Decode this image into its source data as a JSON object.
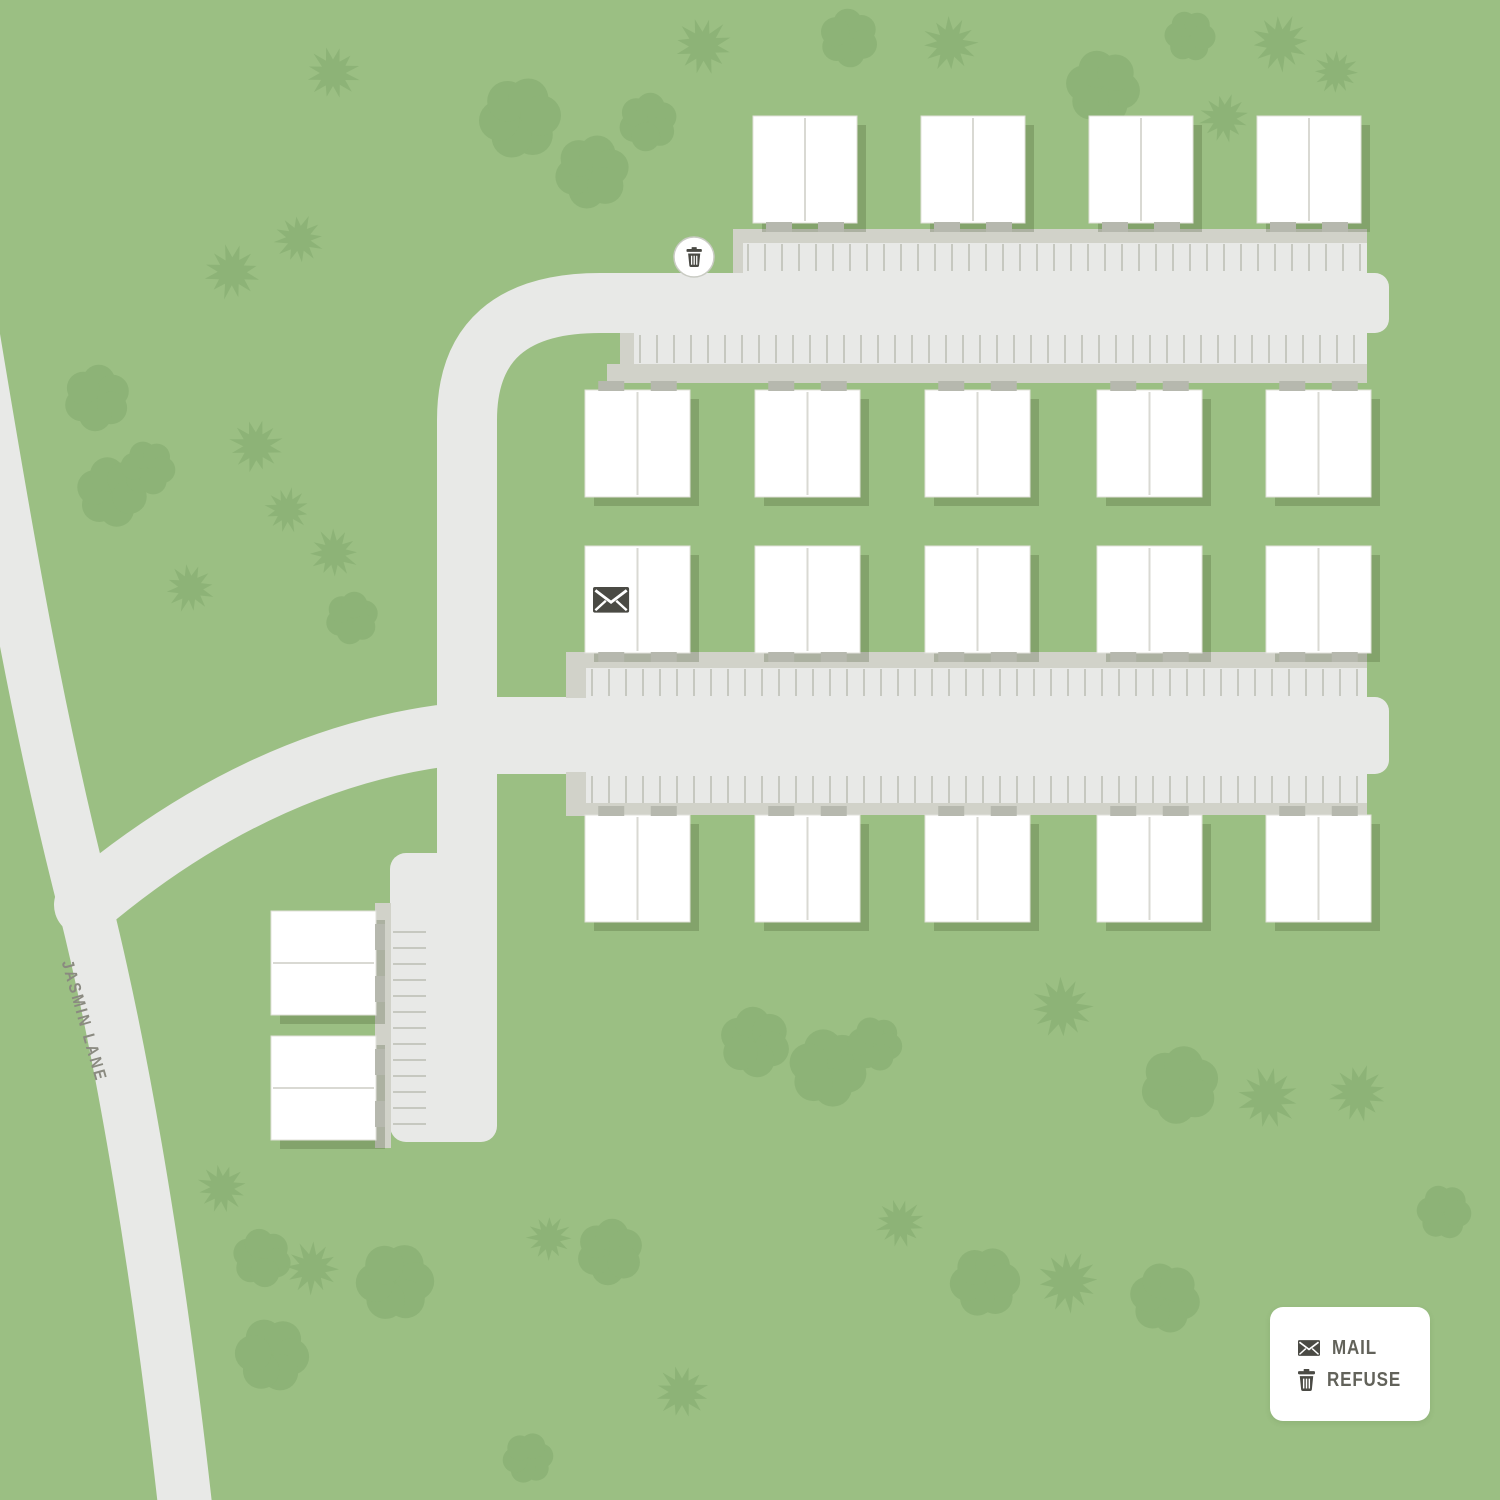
{
  "title": "Jasmin Lane community site map",
  "street": {
    "label": "JASMIN LANE"
  },
  "legend": {
    "items": [
      {
        "icon": "mail-icon",
        "label": "MAIL"
      },
      {
        "icon": "refuse-icon",
        "label": "REFUSE"
      }
    ]
  },
  "colors": {
    "background": "#9bbf83",
    "tree": "#8db377",
    "pavement": "#e8e9e7",
    "sidewalk": "#d1d2c9",
    "stripe": "#c6c8c0",
    "building": "#ffffff",
    "building_border": "#e0e0da",
    "unit_divider": "#d9d9d3",
    "step": "#b6b8ae",
    "shadow": "rgba(55,75,35,0.24)",
    "icon": "#4a4a44",
    "marker_ring": "#c9cbc3",
    "legend_text": "#62625a",
    "street_text": "#8a8a80"
  },
  "map_data": {
    "canvas": {
      "width": 1500,
      "height": 1500
    },
    "roads": [
      {
        "name": "jasmin-lane",
        "d": "M -28 330 C 10 560 40 730 85 905 C 125 1065 160 1280 185 1505",
        "width": 54
      },
      {
        "name": "entry-drive",
        "d": "M 85 905 Q 255 762 440 736 L 600 736",
        "width": 62
      },
      {
        "name": "loop-drive",
        "d": "M 467 1112 L 467 420 Q 467 303 600 303 L 1357 303",
        "width": 60
      }
    ],
    "pavement": [
      {
        "x": 390,
        "y": 853,
        "w": 107,
        "h": 289,
        "rx": 16
      },
      {
        "x": 742,
        "y": 242,
        "w": 625,
        "h": 32,
        "rx": 0
      },
      {
        "x": 633,
        "y": 333,
        "w": 734,
        "h": 33,
        "rx": 0
      },
      {
        "x": 1345,
        "y": 273,
        "w": 44,
        "h": 60,
        "rx": 14
      },
      {
        "x": 490,
        "y": 697,
        "w": 870,
        "h": 77,
        "rx": 0
      },
      {
        "x": 586,
        "y": 667,
        "w": 781,
        "h": 31,
        "rx": 0
      },
      {
        "x": 586,
        "y": 774,
        "w": 781,
        "h": 31,
        "rx": 0
      },
      {
        "x": 1345,
        "y": 697,
        "w": 44,
        "h": 77,
        "rx": 14
      }
    ],
    "sidewalks": [
      {
        "x": 733,
        "y": 229,
        "w": 634,
        "h": 14
      },
      {
        "x": 733,
        "y": 229,
        "w": 10,
        "h": 44
      },
      {
        "x": 607,
        "y": 364,
        "w": 760,
        "h": 19
      },
      {
        "x": 620,
        "y": 333,
        "w": 14,
        "h": 45
      },
      {
        "x": 566,
        "y": 652,
        "w": 801,
        "h": 16
      },
      {
        "x": 566,
        "y": 652,
        "w": 20,
        "h": 46
      },
      {
        "x": 566,
        "y": 803,
        "w": 801,
        "h": 12
      },
      {
        "x": 566,
        "y": 772,
        "w": 20,
        "h": 44
      },
      {
        "x": 375,
        "y": 903,
        "w": 16,
        "h": 245
      }
    ],
    "stripes": [
      {
        "orient": "v",
        "start": 748,
        "spacing": 17,
        "count": 37,
        "from": 244,
        "to": 271
      },
      {
        "orient": "v",
        "start": 640,
        "spacing": 17,
        "count": 43,
        "from": 335,
        "to": 363
      },
      {
        "orient": "v",
        "start": 592,
        "spacing": 17,
        "count": 46,
        "from": 669,
        "to": 696
      },
      {
        "orient": "v",
        "start": 592,
        "spacing": 17,
        "count": 46,
        "from": 776,
        "to": 803
      },
      {
        "orient": "h",
        "start": 932,
        "spacing": 16,
        "count": 13,
        "from": 393,
        "to": 426
      }
    ],
    "building_rows": [
      {
        "y": 116,
        "w": 104,
        "h": 107,
        "lefts": [
          753,
          921,
          1089,
          1257
        ],
        "divider": "v",
        "steps": "bottom"
      },
      {
        "y": 390,
        "w": 105,
        "h": 107,
        "lefts": [
          585,
          755,
          925,
          1097,
          1266
        ],
        "divider": "v",
        "steps": "top"
      },
      {
        "y": 546,
        "w": 105,
        "h": 107,
        "lefts": [
          585,
          755,
          925,
          1097,
          1266
        ],
        "divider": "v",
        "steps": "bottom"
      },
      {
        "y": 815,
        "w": 105,
        "h": 107,
        "lefts": [
          585,
          755,
          925,
          1097,
          1266
        ],
        "divider": "v",
        "steps": "top"
      }
    ],
    "small_buildings": [
      {
        "x": 271,
        "y": 911,
        "w": 105,
        "h": 104,
        "divider": "h",
        "steps": "right"
      },
      {
        "x": 271,
        "y": 1036,
        "w": 105,
        "h": 104,
        "divider": "h",
        "steps": "right"
      }
    ],
    "amenities": {
      "mail": {
        "x": 593,
        "y": 587
      },
      "refuse": {
        "x": 694,
        "y": 257
      }
    },
    "trees": [
      {
        "x": 333,
        "y": 73,
        "r": 26,
        "shape": "star"
      },
      {
        "x": 520,
        "y": 118,
        "r": 42,
        "shape": "round"
      },
      {
        "x": 592,
        "y": 172,
        "r": 38,
        "shape": "round"
      },
      {
        "x": 648,
        "y": 122,
        "r": 30,
        "shape": "round"
      },
      {
        "x": 703,
        "y": 46,
        "r": 28,
        "shape": "star"
      },
      {
        "x": 849,
        "y": 38,
        "r": 30,
        "shape": "round"
      },
      {
        "x": 950,
        "y": 44,
        "r": 27,
        "shape": "star"
      },
      {
        "x": 1103,
        "y": 87,
        "r": 38,
        "shape": "round"
      },
      {
        "x": 1190,
        "y": 36,
        "r": 26,
        "shape": "round"
      },
      {
        "x": 1224,
        "y": 118,
        "r": 24,
        "shape": "star"
      },
      {
        "x": 1280,
        "y": 43,
        "r": 28,
        "shape": "star"
      },
      {
        "x": 1336,
        "y": 72,
        "r": 22,
        "shape": "star"
      },
      {
        "x": 97,
        "y": 398,
        "r": 34,
        "shape": "round"
      },
      {
        "x": 232,
        "y": 272,
        "r": 27,
        "shape": "star"
      },
      {
        "x": 299,
        "y": 239,
        "r": 24,
        "shape": "star"
      },
      {
        "x": 112,
        "y": 492,
        "r": 36,
        "shape": "round"
      },
      {
        "x": 148,
        "y": 468,
        "r": 28,
        "shape": "round"
      },
      {
        "x": 256,
        "y": 446,
        "r": 26,
        "shape": "star"
      },
      {
        "x": 190,
        "y": 588,
        "r": 24,
        "shape": "star"
      },
      {
        "x": 334,
        "y": 553,
        "r": 24,
        "shape": "star"
      },
      {
        "x": 352,
        "y": 618,
        "r": 27,
        "shape": "round"
      },
      {
        "x": 287,
        "y": 510,
        "r": 22,
        "shape": "star"
      },
      {
        "x": 222,
        "y": 1188,
        "r": 24,
        "shape": "star"
      },
      {
        "x": 262,
        "y": 1258,
        "r": 30,
        "shape": "round"
      },
      {
        "x": 312,
        "y": 1268,
        "r": 26,
        "shape": "star"
      },
      {
        "x": 272,
        "y": 1355,
        "r": 38,
        "shape": "round"
      },
      {
        "x": 395,
        "y": 1282,
        "r": 40,
        "shape": "round"
      },
      {
        "x": 528,
        "y": 1458,
        "r": 26,
        "shape": "round"
      },
      {
        "x": 549,
        "y": 1238,
        "r": 22,
        "shape": "star"
      },
      {
        "x": 610,
        "y": 1252,
        "r": 34,
        "shape": "round"
      },
      {
        "x": 682,
        "y": 1392,
        "r": 26,
        "shape": "star"
      },
      {
        "x": 755,
        "y": 1042,
        "r": 36,
        "shape": "round"
      },
      {
        "x": 828,
        "y": 1068,
        "r": 40,
        "shape": "round"
      },
      {
        "x": 875,
        "y": 1044,
        "r": 28,
        "shape": "round"
      },
      {
        "x": 900,
        "y": 1223,
        "r": 24,
        "shape": "star"
      },
      {
        "x": 985,
        "y": 1282,
        "r": 36,
        "shape": "round"
      },
      {
        "x": 1062,
        "y": 1008,
        "r": 30,
        "shape": "star"
      },
      {
        "x": 1180,
        "y": 1085,
        "r": 40,
        "shape": "round"
      },
      {
        "x": 1268,
        "y": 1098,
        "r": 30,
        "shape": "star"
      },
      {
        "x": 1358,
        "y": 1093,
        "r": 28,
        "shape": "star"
      },
      {
        "x": 1068,
        "y": 1282,
        "r": 30,
        "shape": "star"
      },
      {
        "x": 1165,
        "y": 1298,
        "r": 36,
        "shape": "round"
      },
      {
        "x": 1444,
        "y": 1212,
        "r": 28,
        "shape": "round"
      }
    ]
  }
}
